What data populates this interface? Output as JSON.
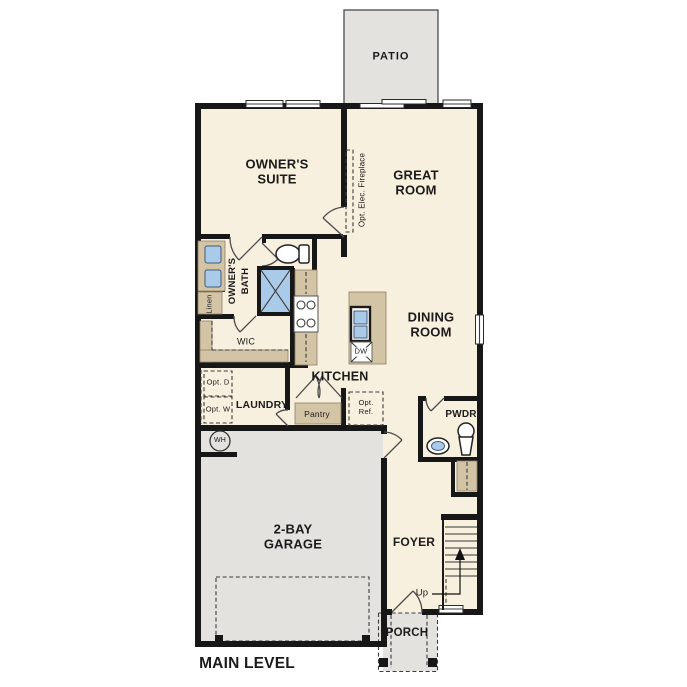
{
  "plan_title": "MAIN LEVEL",
  "colors": {
    "floor": "#f8f0de",
    "outdoor": "#e3e2de",
    "cabinet": "#d4c4a6",
    "fixture": "#a9cbe9",
    "wall": "#171717",
    "text": "#1b1b1b",
    "line": "#3c3c3c"
  },
  "rooms": {
    "patio": "PATIO",
    "owners_suite": "OWNER'S SUITE",
    "great_room": "GREAT ROOM",
    "dining_room": "DINING ROOM",
    "kitchen": "KITCHEN",
    "owners_bath": "OWNER'S BATH",
    "wic": "WIC",
    "laundry": "LAUNDRY",
    "pwdr": "PWDR",
    "garage": "2-BAY GARAGE",
    "foyer": "FOYER",
    "porch": "PORCH"
  },
  "features": {
    "fireplace": "Opt. Elec. Fireplace",
    "linen": "Linen",
    "pantry": "Pantry",
    "opt_ref": "Opt. Ref.",
    "opt_dryer": "Opt. D",
    "opt_washer": "Opt. W",
    "dishwasher": "DW",
    "water_heater": "WH",
    "stairs_up": "Up"
  }
}
